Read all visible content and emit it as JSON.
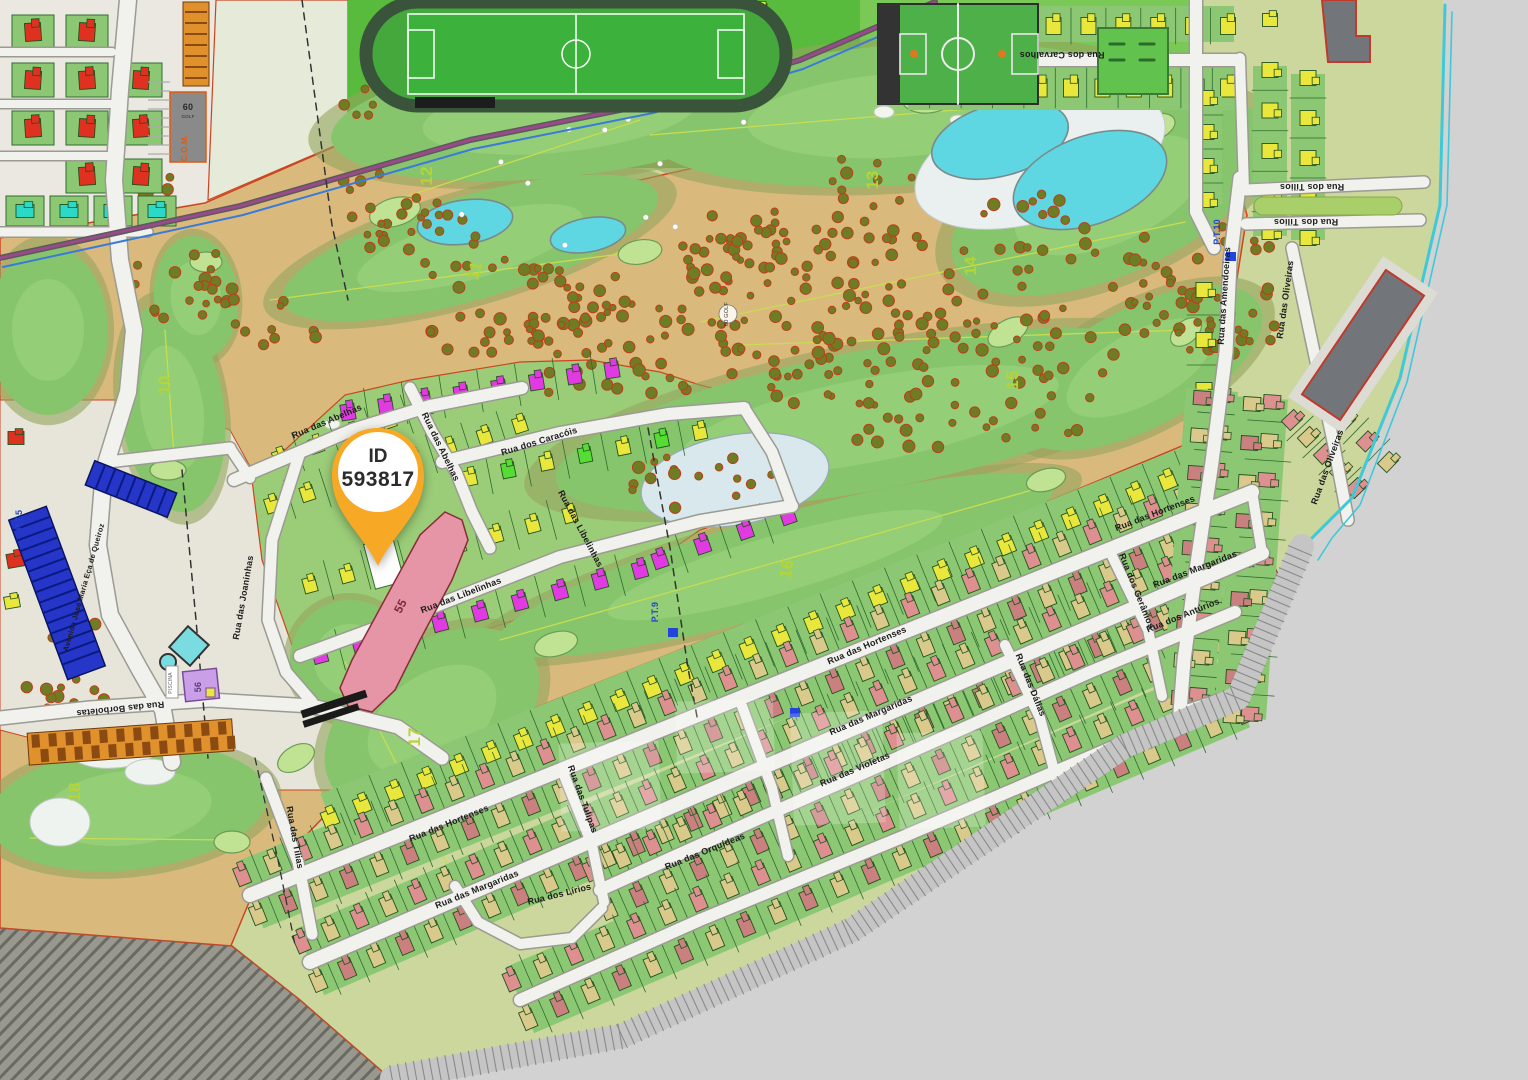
{
  "map": {
    "marker": {
      "line1": "ID",
      "line2": "593817"
    },
    "street_labels": [
      {
        "text": "Rua dos Carvalhos",
        "x": 1062,
        "y": 52,
        "rot": 180
      },
      {
        "text": "Rua dos Tílios",
        "x": 1312,
        "y": 184,
        "rot": 180
      },
      {
        "text": "Rua dos Tílios",
        "x": 1306,
        "y": 219,
        "rot": 180
      },
      {
        "text": "Rua das Amendoeiras",
        "x": 1227,
        "y": 296,
        "rot": -86
      },
      {
        "text": "Rua das Oliveiras",
        "x": 1288,
        "y": 300,
        "rot": -82
      },
      {
        "text": "Rua das Oliveiras",
        "x": 1330,
        "y": 468,
        "rot": -70
      },
      {
        "text": "Rua das Abelhas",
        "x": 328,
        "y": 424,
        "rot": -23
      },
      {
        "text": "Rua das Abelhas",
        "x": 438,
        "y": 448,
        "rot": 64
      },
      {
        "text": "Rua dos Caracóis",
        "x": 540,
        "y": 444,
        "rot": -17
      },
      {
        "text": "Rua das Libelinhas",
        "x": 462,
        "y": 598,
        "rot": -21
      },
      {
        "text": "Rua das Libelinhas",
        "x": 578,
        "y": 530,
        "rot": 62
      },
      {
        "text": "Rua das Joaninhas",
        "x": 246,
        "y": 598,
        "rot": -80
      },
      {
        "text": "Avenida José Maria Eça de Queiroz",
        "x": 86,
        "y": 588,
        "rot": -74,
        "fs": 7.5
      },
      {
        "text": "Rua das Borboletas",
        "x": 120,
        "y": 706,
        "rot": 174
      },
      {
        "text": "Rua das Tílias",
        "x": 292,
        "y": 838,
        "rot": 80
      },
      {
        "text": "Rua das Hortenses",
        "x": 450,
        "y": 826,
        "rot": -22
      },
      {
        "text": "Rua das Hortenses",
        "x": 868,
        "y": 648,
        "rot": -23
      },
      {
        "text": "Rua das Hortenses",
        "x": 1156,
        "y": 516,
        "rot": -21
      },
      {
        "text": "Rua das Margaridas",
        "x": 478,
        "y": 892,
        "rot": -22
      },
      {
        "text": "Rua das Margaridas",
        "x": 872,
        "y": 718,
        "rot": -23
      },
      {
        "text": "Rua das Margaridas",
        "x": 1196,
        "y": 572,
        "rot": -21
      },
      {
        "text": "Rua dos Lírios",
        "x": 560,
        "y": 897,
        "rot": -14
      },
      {
        "text": "Rua das Orquídeas",
        "x": 706,
        "y": 854,
        "rot": -22
      },
      {
        "text": "Rua das Violetas",
        "x": 856,
        "y": 772,
        "rot": -23
      },
      {
        "text": "Rua dos Antúrios",
        "x": 1184,
        "y": 618,
        "rot": -22
      },
      {
        "text": "Rua das Dálias",
        "x": 1028,
        "y": 686,
        "rot": 68
      },
      {
        "text": "Rua das Tulipas",
        "x": 580,
        "y": 800,
        "rot": 70
      },
      {
        "text": "Rua dos Gerânios",
        "x": 1134,
        "y": 592,
        "rot": 68
      }
    ],
    "golf_hole_labels": [
      {
        "text": "10",
        "x": 170,
        "y": 385,
        "rot": -90
      },
      {
        "text": "11",
        "x": 480,
        "y": 272,
        "rot": -75
      },
      {
        "text": "12",
        "x": 432,
        "y": 176,
        "rot": -90
      },
      {
        "text": "13",
        "x": 878,
        "y": 180,
        "rot": -90
      },
      {
        "text": "14",
        "x": 976,
        "y": 266,
        "rot": -90
      },
      {
        "text": "15",
        "x": 1018,
        "y": 380,
        "rot": -90
      },
      {
        "text": "16",
        "x": 792,
        "y": 570,
        "rot": -80
      },
      {
        "text": "17",
        "x": 420,
        "y": 737,
        "rot": -90
      },
      {
        "text": "18",
        "x": 80,
        "y": 792,
        "rot": -90
      }
    ],
    "utility_labels": [
      {
        "text": "P.T.5",
        "x": 22,
        "y": 520,
        "rot": -90
      },
      {
        "text": "P.T.9",
        "x": 658,
        "y": 612,
        "rot": -90
      },
      {
        "text": "P.T.10",
        "x": 1220,
        "y": 232,
        "rot": -90
      }
    ],
    "small_labels": [
      {
        "text": "60",
        "x": 188,
        "y": 110,
        "rot": 0,
        "fs": 9,
        "color": "#2a2a2a",
        "bold": true
      },
      {
        "text": "GOLF",
        "x": 188,
        "y": 118,
        "rot": 0,
        "fs": 4.5,
        "color": "#2a2a2a"
      },
      {
        "text": "C.O.M.",
        "x": 187,
        "y": 148,
        "rot": -90,
        "fs": 8,
        "color": "#e05a10",
        "bold": true
      },
      {
        "text": "60 GOLF",
        "x": 728,
        "y": 314,
        "rot": -90,
        "fs": 5.5,
        "color": "#333333"
      },
      {
        "text": "55",
        "x": 404,
        "y": 608,
        "rot": -62,
        "fs": 12,
        "color": "#7a2a3a",
        "bold": true
      },
      {
        "text": "56",
        "x": 201,
        "y": 687,
        "rot": -90,
        "fs": 9,
        "color": "#5a3a7a",
        "bold": true
      },
      {
        "text": "PISCINA",
        "x": 172,
        "y": 683,
        "rot": -90,
        "fs": 5,
        "color": "#666666"
      }
    ],
    "colors": {
      "marker_orange": "#F7A824",
      "terrain_tan": "#d9ba7c",
      "fairway_green": "#87c56d",
      "plot_green": "#8cc873",
      "lake_cyan": "#5fd7e2",
      "house_yellow": "#e9e73b",
      "house_magenta": "#e23ae2",
      "house_red": "#e03020",
      "house_pink": "#de9090",
      "house_tan": "#d9c98a",
      "hole_number_green": "#b5d435",
      "pt_blue": "#2244cc",
      "boundary_red": "#cc4422",
      "out_of_plan_gray": "#d2d2d2"
    }
  }
}
